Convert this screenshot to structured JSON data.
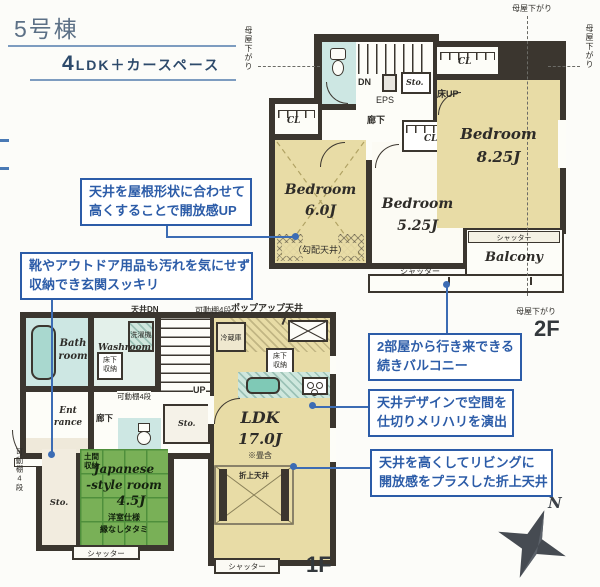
{
  "title": {
    "building": "5号棟",
    "layout_number": "4",
    "layout_text": "LDK＋カースペース"
  },
  "annotations": {
    "roof": {
      "line1": "天井を屋根形状に合わせて",
      "line2": "高くすることで開放感UP"
    },
    "entrance": {
      "line1": "靴やアウトドア用品も汚れを気にせず",
      "line2": "収納でき玄関スッキリ"
    },
    "balcony": {
      "line1": "2部屋から行き来できる",
      "line2": "続きバルコニー"
    },
    "ceiling_design": {
      "line1": "天井デザインで空間を",
      "line2": "仕切りメリハリを演出"
    },
    "living_ceiling": {
      "line1": "天井を高くしてリビングに",
      "line2": "開放感をプラスした折上天井"
    }
  },
  "floor2": {
    "label": "2F",
    "bedroom_6": {
      "name": "Bedroom",
      "size": "6.0J",
      "note": "（勾配天井）"
    },
    "bedroom_525": {
      "name": "Bedroom",
      "size": "5.25J"
    },
    "bedroom_825": {
      "name": "Bedroom",
      "size": "8.25J"
    },
    "balcony": "Balcony",
    "cl": "CL",
    "dn": "DN",
    "eps": "EPS",
    "sto": "Sto.",
    "floor_up": "床UP",
    "hallway": "廊下",
    "shutter": "シャッター",
    "eaves": "母屋下がり"
  },
  "floor1": {
    "label": "1F",
    "bath": {
      "line1": "Bath",
      "line2": "room"
    },
    "washroom": "Washroom",
    "washer": "洗濯機",
    "underfloor": {
      "line1": "床下",
      "line2": "収納"
    },
    "shelf": "可動棚4段",
    "ceiling_dn": "天井DN",
    "up": "UP",
    "hallway": "廊下",
    "entrance": {
      "line1": "Ent",
      "line2": "rance"
    },
    "doma": {
      "line1": "土間",
      "line2": "収納"
    },
    "japanese": {
      "line1": "Japanese",
      "line2": "-style room",
      "size": "4.5J",
      "note1": "洋室仕様",
      "note2": "縁なしタタミ"
    },
    "sto": "Sto.",
    "ldk": {
      "name": "LDK",
      "size": "17.0J",
      "note": "※畳含"
    },
    "popup_ceiling": "ポップアップ天井",
    "fridge": "冷蔵庫",
    "coffered": "折上天井",
    "shutter": "シャッター"
  },
  "compass": {
    "north": "N"
  },
  "colors": {
    "annotation_blue": "#2c5ca8",
    "leader_blue": "#3c6cb4",
    "wall": "#3b362f",
    "room_beige": "#e8dca6",
    "water_blue": "#cde7e3",
    "tatami_green": "#79b057",
    "title_blue": "#5c7086"
  }
}
